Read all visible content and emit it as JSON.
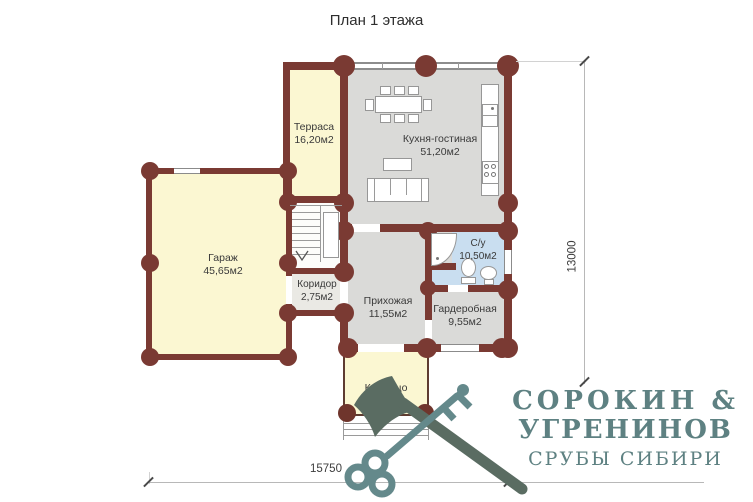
{
  "title": "План 1 этажа",
  "rooms": [
    {
      "name": "Терраса",
      "area": "16,20м2"
    },
    {
      "name": "Кухня-гостиная",
      "area": "51,20м2"
    },
    {
      "name": "Гараж",
      "area": "45,65м2"
    },
    {
      "name": "Коридор",
      "area": "2,75м2"
    },
    {
      "name": "Прихожая",
      "area": "11,55м2"
    },
    {
      "name": "С/у",
      "area": "10,50м2"
    },
    {
      "name": "Гардеробная",
      "area": "9,55м2"
    },
    {
      "name": "Крыльцо",
      "area": "9,10м2"
    }
  ],
  "dimensions": {
    "horizontal": "15750",
    "vertical": "13000"
  },
  "logo": {
    "line1": "СОРОКИН &",
    "line2": "УГРЕНИНОВ",
    "line3": "СРУБЫ СИБИРИ"
  },
  "colors": {
    "wall": "#7a3a33",
    "floor_warm": "#fbf7d2",
    "floor_grey": "#dadad8",
    "floor_bath": "#c9def0",
    "logo_teal": "#5e8182",
    "logo_axe": "#5a6c62"
  }
}
